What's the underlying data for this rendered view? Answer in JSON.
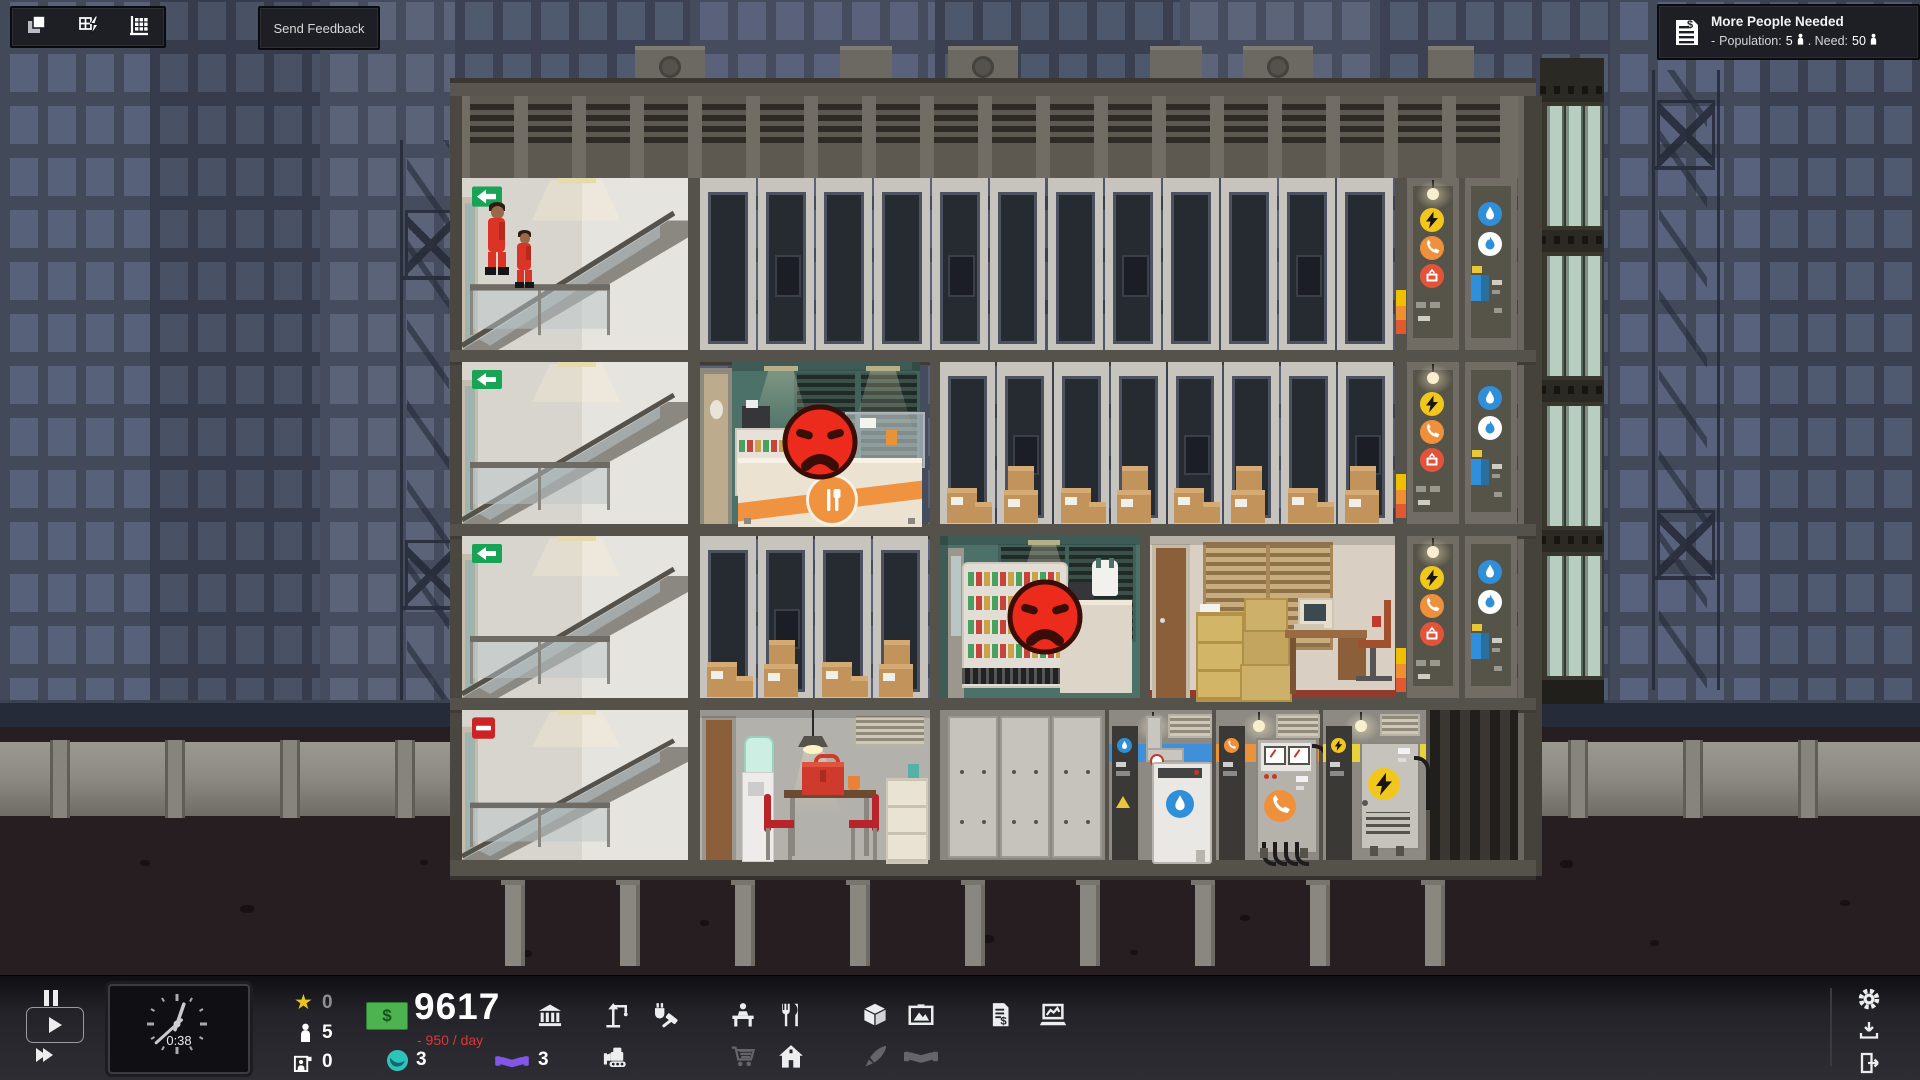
{
  "top_toolbar": {
    "buttons": [
      {
        "icon": "layers-icon",
        "name": "overlay-layers"
      },
      {
        "icon": "grid-power-icon",
        "name": "overlay-utilities"
      },
      {
        "icon": "building-chart-icon",
        "name": "overlay-zoning"
      }
    ]
  },
  "feedback": {
    "label": "Send Feedback"
  },
  "notification": {
    "icon": "invoice-icon",
    "title": "More People Needed",
    "bullet": "-",
    "population_label": "Population:",
    "population_value": "5",
    "need_label": ". Need:",
    "need_value": "50"
  },
  "hud": {
    "clock_time": "0:38",
    "playback": {
      "selected": "play",
      "buttons": [
        "pause",
        "play",
        "fast-forward"
      ]
    },
    "stats": {
      "stars": "0",
      "population": "5",
      "staff": "0"
    },
    "money": {
      "balance": "9617",
      "cashflow": "- 950 / day",
      "influence": "3",
      "favors": "3"
    },
    "build_menu_row1": [
      "construction-crane",
      "utilities-tools",
      "office-desk",
      "food-service",
      "goods-box",
      "artwork",
      "contracts",
      "reports"
    ],
    "build_menu_row2": [
      "bulldozer",
      "shopping-cart",
      "residential-home",
      "paint-brush",
      "deals-handshake"
    ],
    "system_menu": [
      "settings-gear",
      "save-download",
      "exit-door"
    ]
  },
  "scene": {
    "floors": 4,
    "empty_units_top_floor": 12,
    "storage_units_floor2": 8,
    "storage_units_floor3": 4,
    "angry_tenants": 2,
    "workers_visible": 2,
    "utility_risers": [
      "electric",
      "phone",
      "cable-tv",
      "water",
      "gas"
    ],
    "ground_rooms": [
      "stairwell",
      "break-room",
      "elevator-panels",
      "water-utility",
      "phone-utility",
      "power-utility"
    ],
    "colors": {
      "accent_orange": "#ef9340",
      "accent_teal": "#4c7168",
      "angry_red": "#ec2b1c",
      "money_green": "#4db351",
      "loss_red": "#e03636",
      "influence_teal": "#2cc4ba",
      "favor_purple": "#8456e8",
      "stripe_water": "#3f8fd9",
      "stripe_phone": "#ec9239",
      "stripe_power": "#ead23a"
    }
  }
}
